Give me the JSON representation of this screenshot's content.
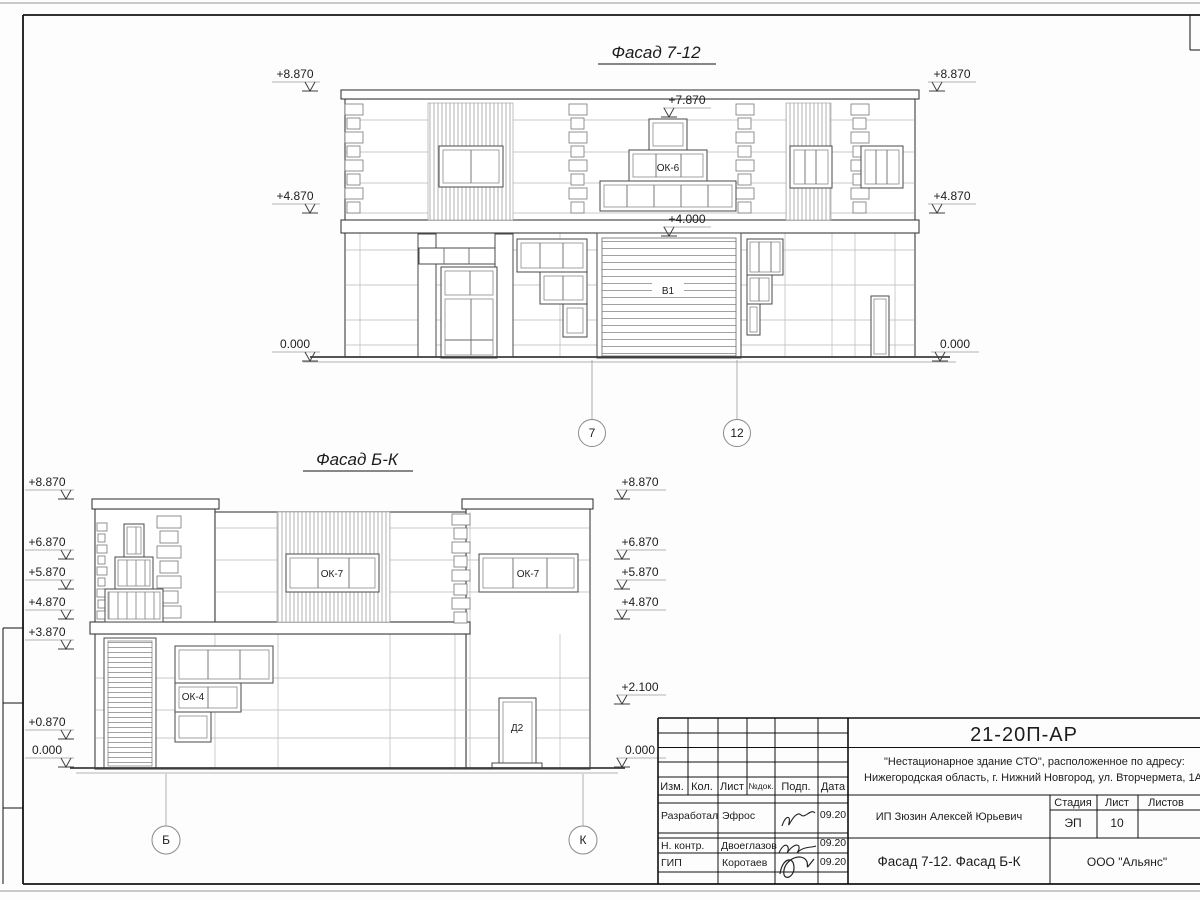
{
  "facade712": {
    "title": "Фасад 7-12",
    "marks_left": [
      "+8.870",
      "+4.870",
      "0.000"
    ],
    "marks_right": [
      "+8.870",
      "+4.870",
      "0.000"
    ],
    "mark_peak": "+7.870",
    "mark_door": "+4.000",
    "labels": {
      "ok6": "ОК-6",
      "v1": "В1"
    },
    "axes": [
      "7",
      "12"
    ]
  },
  "facadeBK": {
    "title": "Фасад Б-К",
    "marks_left": [
      "+8.870",
      "+6.870",
      "+5.870",
      "+4.870",
      "+3.870",
      "+0.870",
      "0.000"
    ],
    "marks_right": [
      "+8.870",
      "+6.870",
      "+5.870",
      "+4.870",
      "+2.100",
      "0.000"
    ],
    "labels": {
      "ok7_left": "ОК-7",
      "ok7_right": "ОК-7",
      "ok4": "ОК-4",
      "d2": "Д2"
    },
    "axes": [
      "Б",
      "К"
    ]
  },
  "titleblock": {
    "doc_number": "21-20П-АР",
    "project_line1": "\"Нестационарное здание СТО\", расположенное по адресу:",
    "project_line2": "Нижегородская область, г. Нижний Новгород, ул. Вторчермета, 1А",
    "client": "ИП Зюзин Алексей Юрьевич",
    "sheet_title": "Фасад 7-12. Фасад Б-К",
    "company": "ООО \"Альянс\"",
    "stage_label": "Стадия",
    "sheet_label": "Лист",
    "sheets_label": "Листов",
    "stage": "ЭП",
    "sheet_no": "10",
    "cols": {
      "izm": "Изм.",
      "kol": "Кол.",
      "list": "Лист",
      "ndok": "№док.",
      "podp": "Подп.",
      "data": "Дата"
    },
    "rows": [
      {
        "role": "Разработал",
        "name": "Эфрос",
        "date": "09.20"
      },
      {
        "role": "Н. контр.",
        "name": "Двоеглазов",
        "date": "09.20"
      },
      {
        "role": "ГИП",
        "name": "Коротаев",
        "date": "09.20"
      }
    ]
  }
}
